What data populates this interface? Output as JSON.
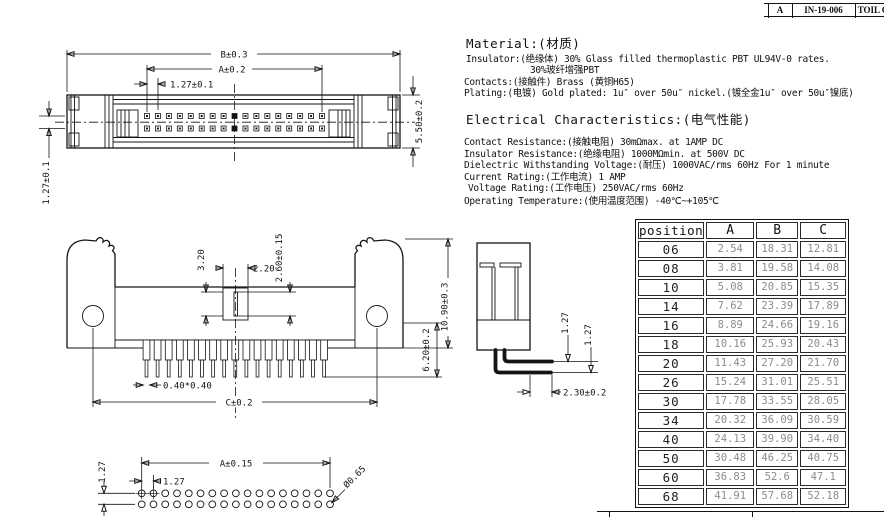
{
  "revision_block": {
    "rev": "A",
    "doc_no": "IN-19-006",
    "note": "TOIL C"
  },
  "material": {
    "heading": "Material:(材质)",
    "insulator_line1": "Insulator:(绝缘体) 30% Glass filled thermoplastic PBT UL94V-0 rates.",
    "insulator_line2": "30%玻纤增强PBT",
    "contacts": "Contacts:(接触件) Brass (黄铜H65)",
    "plating": "Plating:(电镀) Gold plated: 1u″ over 50u″ nickel.(镀全金1u″ over 50u″镍底)"
  },
  "electrical": {
    "heading": "Electrical Characteristics:(电气性能)",
    "lines": [
      "Contact Resistance:(接触电阻) 30mΩmax. at 1AMP DC",
      "Insulator Resistance:(绝缘电阻) 1000MΩmin. at 500V DC",
      "Dielectric Withstanding Voltage:(耐压) 1000VAC/rms 60Hz For 1 minute",
      "Current Rating:(工作电流) 1 AMP",
      "Voltage Rating:(工作电压) 250VAC/rms 60Hz",
      "Operating Temperature:(使用温度范围) -40℃~+105℃"
    ]
  },
  "dims": {
    "top_view": {
      "b": "B±0.3",
      "a": "A±0.2",
      "pitch": "1.27±0.1",
      "height": "5.50±0.2",
      "row_pitch": "1.27±0.1"
    },
    "front_view": {
      "key_h": "3.20",
      "key_w": "2.20",
      "slot": "2.60±0.15",
      "pin_len": "6.20±0.2",
      "total_h": "10.90±0.3",
      "pin_sq": "0.40*0.40",
      "span": "C±0.2"
    },
    "side_view": {
      "pitch1": "1.27",
      "pitch2": "1.27",
      "tail": "2.30±0.2"
    },
    "footprint": {
      "a": "A±0.15",
      "pitch": "1.27",
      "row_pitch": "1.27",
      "hole": "Ø0.65"
    }
  },
  "spec_table": {
    "headers": [
      "position",
      "A",
      "B",
      "C"
    ],
    "rows": [
      [
        "06",
        "2.54",
        "18.31",
        "12.81"
      ],
      [
        "08",
        "3.81",
        "19.58",
        "14.08"
      ],
      [
        "10",
        "5.08",
        "20.85",
        "15.35"
      ],
      [
        "14",
        "7.62",
        "23.39",
        "17.89"
      ],
      [
        "16",
        "8.89",
        "24.66",
        "19.16"
      ],
      [
        "18",
        "10.16",
        "25.93",
        "20.43"
      ],
      [
        "20",
        "11.43",
        "27.20",
        "21.70"
      ],
      [
        "26",
        "15.24",
        "31.01",
        "25.51"
      ],
      [
        "30",
        "17.78",
        "33.55",
        "28.05"
      ],
      [
        "34",
        "20.32",
        "36.09",
        "30.59"
      ],
      [
        "40",
        "24.13",
        "39.90",
        "34.40"
      ],
      [
        "50",
        "30.48",
        "46.25",
        "40.75"
      ],
      [
        "60",
        "36.83",
        "52.6",
        "47.1"
      ],
      [
        "68",
        "41.91",
        "57.68",
        "52.18"
      ]
    ]
  }
}
